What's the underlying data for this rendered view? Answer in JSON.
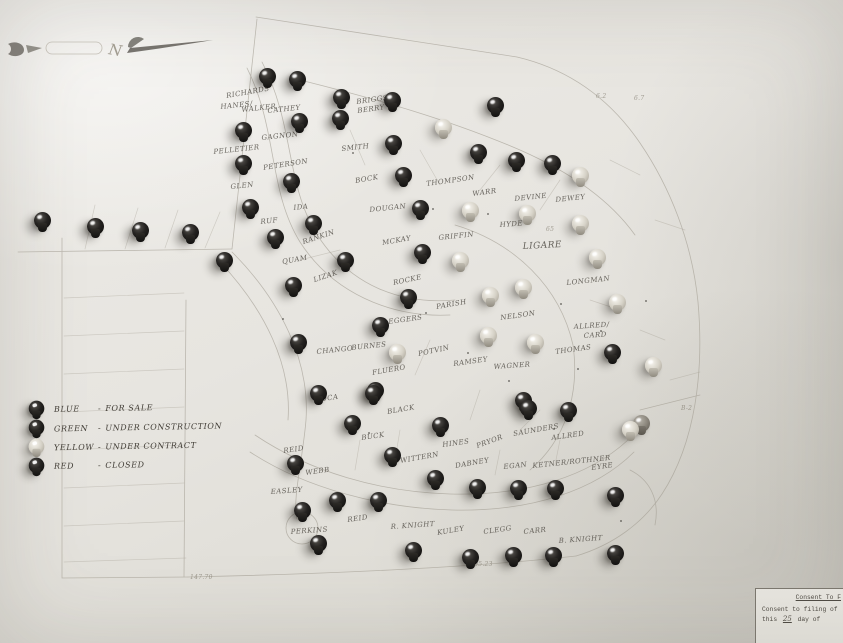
{
  "compass": {
    "letter": "N"
  },
  "legend": {
    "items": [
      {
        "color_name": "BLUE",
        "sep": "-",
        "status": "FOR SALE",
        "pin": "dark"
      },
      {
        "color_name": "GREEN",
        "sep": "-",
        "status": "UNDER CONSTRUCTION",
        "pin": "dark"
      },
      {
        "color_name": "YELLOW",
        "sep": "-",
        "status": "UNDER CONTRACT",
        "pin": "light"
      },
      {
        "color_name": "RED",
        "sep": "-",
        "status": "CLOSED",
        "pin": "dark"
      }
    ]
  },
  "corner_note": {
    "heading": "Consent To F",
    "line1": "Consent to filing of",
    "line2_prefix": "this",
    "line2_value": "25",
    "line2_suffix": "day of"
  },
  "colors": {
    "paper": "#e7e5e0",
    "ink": "#55514a",
    "plat_line": "#a49f94",
    "pin_dark": "#16140f",
    "pin_light": "#d5d1c6"
  },
  "map": {
    "pins": [
      {
        "x": 267,
        "y": 76,
        "s": "dark"
      },
      {
        "x": 297,
        "y": 79,
        "s": "dark"
      },
      {
        "x": 341,
        "y": 97,
        "s": "dark"
      },
      {
        "x": 392,
        "y": 100,
        "s": "dark"
      },
      {
        "x": 495,
        "y": 105,
        "s": "dark"
      },
      {
        "x": 443,
        "y": 127,
        "s": "light"
      },
      {
        "x": 243,
        "y": 130,
        "s": "dark"
      },
      {
        "x": 299,
        "y": 121,
        "s": "dark"
      },
      {
        "x": 340,
        "y": 118,
        "s": "dark"
      },
      {
        "x": 393,
        "y": 143,
        "s": "dark"
      },
      {
        "x": 478,
        "y": 152,
        "s": "dark"
      },
      {
        "x": 516,
        "y": 160,
        "s": "dark"
      },
      {
        "x": 552,
        "y": 163,
        "s": "dark"
      },
      {
        "x": 243,
        "y": 163,
        "s": "dark"
      },
      {
        "x": 291,
        "y": 181,
        "s": "dark"
      },
      {
        "x": 403,
        "y": 175,
        "s": "dark"
      },
      {
        "x": 42,
        "y": 220,
        "s": "dark"
      },
      {
        "x": 95,
        "y": 226,
        "s": "dark"
      },
      {
        "x": 140,
        "y": 230,
        "s": "dark"
      },
      {
        "x": 190,
        "y": 232,
        "s": "dark"
      },
      {
        "x": 250,
        "y": 207,
        "s": "dark"
      },
      {
        "x": 224,
        "y": 260,
        "s": "dark"
      },
      {
        "x": 313,
        "y": 223,
        "s": "dark"
      },
      {
        "x": 275,
        "y": 237,
        "s": "dark"
      },
      {
        "x": 345,
        "y": 260,
        "s": "dark"
      },
      {
        "x": 293,
        "y": 285,
        "s": "dark"
      },
      {
        "x": 420,
        "y": 208,
        "s": "dark"
      },
      {
        "x": 422,
        "y": 252,
        "s": "dark"
      },
      {
        "x": 580,
        "y": 175,
        "s": "light"
      },
      {
        "x": 470,
        "y": 210,
        "s": "light"
      },
      {
        "x": 527,
        "y": 213,
        "s": "light"
      },
      {
        "x": 580,
        "y": 223,
        "s": "light"
      },
      {
        "x": 460,
        "y": 260,
        "s": "light"
      },
      {
        "x": 597,
        "y": 257,
        "s": "light"
      },
      {
        "x": 490,
        "y": 295,
        "s": "light"
      },
      {
        "x": 523,
        "y": 287,
        "s": "light"
      },
      {
        "x": 617,
        "y": 302,
        "s": "light"
      },
      {
        "x": 408,
        "y": 297,
        "s": "dark"
      },
      {
        "x": 380,
        "y": 325,
        "s": "dark"
      },
      {
        "x": 488,
        "y": 335,
        "s": "light"
      },
      {
        "x": 535,
        "y": 342,
        "s": "light"
      },
      {
        "x": 397,
        "y": 352,
        "s": "light"
      },
      {
        "x": 653,
        "y": 365,
        "s": "light"
      },
      {
        "x": 612,
        "y": 352,
        "s": "dark"
      },
      {
        "x": 298,
        "y": 342,
        "s": "dark"
      },
      {
        "x": 375,
        "y": 390,
        "s": "dark"
      },
      {
        "x": 523,
        "y": 400,
        "s": "dark"
      },
      {
        "x": 568,
        "y": 410,
        "s": "dark"
      },
      {
        "x": 528,
        "y": 408,
        "s": "dark"
      },
      {
        "x": 641,
        "y": 423,
        "s": "mid"
      },
      {
        "x": 630,
        "y": 429,
        "s": "light"
      },
      {
        "x": 318,
        "y": 393,
        "s": "dark"
      },
      {
        "x": 373,
        "y": 393,
        "s": "dark"
      },
      {
        "x": 352,
        "y": 423,
        "s": "dark"
      },
      {
        "x": 440,
        "y": 425,
        "s": "dark"
      },
      {
        "x": 392,
        "y": 455,
        "s": "dark"
      },
      {
        "x": 295,
        "y": 463,
        "s": "dark"
      },
      {
        "x": 435,
        "y": 478,
        "s": "dark"
      },
      {
        "x": 477,
        "y": 487,
        "s": "dark"
      },
      {
        "x": 337,
        "y": 500,
        "s": "dark"
      },
      {
        "x": 378,
        "y": 500,
        "s": "dark"
      },
      {
        "x": 302,
        "y": 510,
        "s": "dark"
      },
      {
        "x": 518,
        "y": 488,
        "s": "dark"
      },
      {
        "x": 555,
        "y": 488,
        "s": "dark"
      },
      {
        "x": 615,
        "y": 495,
        "s": "dark"
      },
      {
        "x": 318,
        "y": 543,
        "s": "dark"
      },
      {
        "x": 413,
        "y": 550,
        "s": "dark"
      },
      {
        "x": 470,
        "y": 557,
        "s": "dark"
      },
      {
        "x": 513,
        "y": 555,
        "s": "dark"
      },
      {
        "x": 553,
        "y": 555,
        "s": "dark"
      },
      {
        "x": 615,
        "y": 553,
        "s": "dark"
      }
    ],
    "labels": [
      {
        "t": "RICHARDS",
        "x": 227,
        "y": 92,
        "r": -10
      },
      {
        "t": "HANES/",
        "x": 221,
        "y": 103,
        "r": -6
      },
      {
        "t": "WALKER",
        "x": 242,
        "y": 106,
        "r": -6
      },
      {
        "t": "CATHEY",
        "x": 268,
        "y": 107,
        "r": -6
      },
      {
        "t": "BRIGGS/",
        "x": 357,
        "y": 98,
        "r": -8
      },
      {
        "t": "BERRY",
        "x": 358,
        "y": 107,
        "r": -8
      },
      {
        "t": "GAGNON",
        "x": 262,
        "y": 134,
        "r": -6
      },
      {
        "t": "SMITH",
        "x": 342,
        "y": 145,
        "r": -6
      },
      {
        "t": "PELLETIER",
        "x": 214,
        "y": 148,
        "r": -6
      },
      {
        "t": "PETERSON",
        "x": 264,
        "y": 164,
        "r": -9
      },
      {
        "t": "GLEN",
        "x": 231,
        "y": 183,
        "r": -6
      },
      {
        "t": "BOCK",
        "x": 356,
        "y": 177,
        "r": -10
      },
      {
        "t": "THOMPSON",
        "x": 427,
        "y": 180,
        "r": -8
      },
      {
        "t": "DOUGAN",
        "x": 370,
        "y": 206,
        "r": -6
      },
      {
        "t": "IDA",
        "x": 294,
        "y": 204,
        "r": -6
      },
      {
        "t": "RUF",
        "x": 261,
        "y": 218,
        "r": -6
      },
      {
        "t": "WARR",
        "x": 473,
        "y": 190,
        "r": -8
      },
      {
        "t": "DEVINE",
        "x": 515,
        "y": 195,
        "r": -6
      },
      {
        "t": "DEWEY",
        "x": 556,
        "y": 196,
        "r": -6
      },
      {
        "t": "HYDE",
        "x": 500,
        "y": 221,
        "r": -4
      },
      {
        "t": "MCKAY",
        "x": 383,
        "y": 239,
        "r": -10
      },
      {
        "t": "GRIFFIN",
        "x": 439,
        "y": 234,
        "r": -6
      },
      {
        "t": "LIGARE",
        "x": 523,
        "y": 242,
        "r": -3,
        "fs": 9
      },
      {
        "t": "RANKIN",
        "x": 304,
        "y": 238,
        "r": -18
      },
      {
        "t": "QUAM",
        "x": 283,
        "y": 258,
        "r": -10
      },
      {
        "t": "LIZAK",
        "x": 315,
        "y": 276,
        "r": -18
      },
      {
        "t": "ROCKE",
        "x": 394,
        "y": 279,
        "r": -12
      },
      {
        "t": "LONGMAN",
        "x": 567,
        "y": 279,
        "r": -6
      },
      {
        "t": "EGGERS",
        "x": 389,
        "y": 318,
        "r": -8
      },
      {
        "t": "PARISH",
        "x": 437,
        "y": 303,
        "r": -10
      },
      {
        "t": "NELSON",
        "x": 501,
        "y": 314,
        "r": -8
      },
      {
        "t": "ALLRED/",
        "x": 574,
        "y": 323,
        "r": -4
      },
      {
        "t": "CARD",
        "x": 584,
        "y": 332,
        "r": -4
      },
      {
        "t": "CHANGO",
        "x": 317,
        "y": 348,
        "r": -6
      },
      {
        "t": "BURNES",
        "x": 352,
        "y": 344,
        "r": -6
      },
      {
        "t": "POTVIN",
        "x": 419,
        "y": 350,
        "r": -12
      },
      {
        "t": "RAMSEY",
        "x": 454,
        "y": 360,
        "r": -8
      },
      {
        "t": "WAGNER",
        "x": 494,
        "y": 363,
        "r": -4
      },
      {
        "t": "THOMAS",
        "x": 556,
        "y": 348,
        "r": -8
      },
      {
        "t": "FLUERO",
        "x": 373,
        "y": 369,
        "r": -10
      },
      {
        "t": "ROCA",
        "x": 316,
        "y": 396,
        "r": -8
      },
      {
        "t": "BLACK",
        "x": 388,
        "y": 408,
        "r": -10
      },
      {
        "t": "BUCK",
        "x": 362,
        "y": 434,
        "r": -8
      },
      {
        "t": "HINES",
        "x": 443,
        "y": 441,
        "r": -8
      },
      {
        "t": "PRYOR",
        "x": 478,
        "y": 442,
        "r": -20
      },
      {
        "t": "SAUNDERS",
        "x": 514,
        "y": 430,
        "r": -10
      },
      {
        "t": "ALLRED",
        "x": 552,
        "y": 434,
        "r": -8
      },
      {
        "t": "WITTERN",
        "x": 401,
        "y": 457,
        "r": -10
      },
      {
        "t": "DABNEY",
        "x": 456,
        "y": 462,
        "r": -10
      },
      {
        "t": "REID",
        "x": 284,
        "y": 447,
        "r": -8
      },
      {
        "t": "WEBB",
        "x": 306,
        "y": 469,
        "r": -8
      },
      {
        "t": "EASLEY",
        "x": 271,
        "y": 488,
        "r": -4
      },
      {
        "t": "EGAN",
        "x": 504,
        "y": 463,
        "r": -6
      },
      {
        "t": "KETNER/ROTHNER",
        "x": 533,
        "y": 462,
        "r": -6
      },
      {
        "t": "EYRE",
        "x": 592,
        "y": 464,
        "r": -8
      },
      {
        "t": "PERKINS",
        "x": 291,
        "y": 528,
        "r": -4
      },
      {
        "t": "REID",
        "x": 348,
        "y": 516,
        "r": -8
      },
      {
        "t": "R. KNIGHT",
        "x": 391,
        "y": 523,
        "r": -4
      },
      {
        "t": "KULEY",
        "x": 438,
        "y": 529,
        "r": -10
      },
      {
        "t": "CLEGG",
        "x": 484,
        "y": 528,
        "r": -8
      },
      {
        "t": "CARR",
        "x": 524,
        "y": 528,
        "r": -6
      },
      {
        "t": "B. KNIGHT",
        "x": 559,
        "y": 537,
        "r": -4
      }
    ],
    "dims": [
      {
        "t": "105.23",
        "x": 470,
        "y": 561
      },
      {
        "t": "147.70",
        "x": 190,
        "y": 574
      },
      {
        "t": "B-2",
        "x": 681,
        "y": 405
      },
      {
        "t": "6.2",
        "x": 596,
        "y": 93
      },
      {
        "t": "6.7",
        "x": 634,
        "y": 95
      },
      {
        "t": "65",
        "x": 546,
        "y": 226
      }
    ],
    "dots": [
      [
        432,
        208
      ],
      [
        487,
        213
      ],
      [
        352,
        152
      ],
      [
        560,
        303
      ],
      [
        467,
        352
      ],
      [
        425,
        312
      ],
      [
        348,
        255
      ],
      [
        553,
        428
      ],
      [
        600,
        330
      ],
      [
        368,
        432
      ],
      [
        620,
        520
      ],
      [
        282,
        318
      ],
      [
        508,
        380
      ],
      [
        577,
        368
      ],
      [
        645,
        300
      ]
    ]
  }
}
